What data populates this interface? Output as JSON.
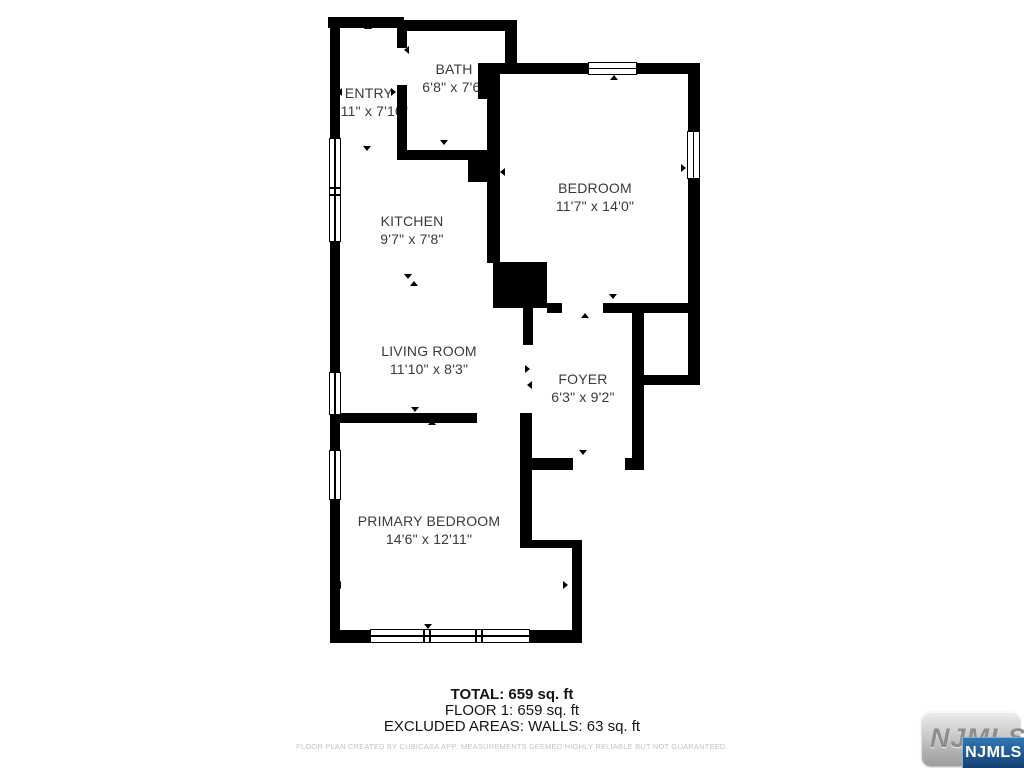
{
  "plan": {
    "rooms": [
      {
        "name": "ENTRY",
        "dimensions": "3'11\" x 7'10\""
      },
      {
        "name": "BATH",
        "dimensions": "6'8\" x 7'6\""
      },
      {
        "name": "BEDROOM",
        "dimensions": "11'7\" x 14'0\""
      },
      {
        "name": "KITCHEN",
        "dimensions": "9'7\" x 7'8\""
      },
      {
        "name": "LIVING ROOM",
        "dimensions": "11'10\" x 8'3\""
      },
      {
        "name": "FOYER",
        "dimensions": "6'3\" x 9'2\""
      },
      {
        "name": "PRIMARY BEDROOM",
        "dimensions": "14'6\" x 12'11\""
      }
    ]
  },
  "summary": {
    "total": "TOTAL: 659 sq. ft",
    "floor1": "FLOOR 1: 659 sq. ft",
    "excluded": "EXCLUDED AREAS: WALLS: 63 sq. ft",
    "disclaimer": "FLOOR PLAN CREATED BY CUBICASA APP; MEASUREMENTS DEEMED HIGHLY RELIABLE BUT NOT GUARANTEED."
  },
  "logo": {
    "back": "NJMLS",
    "front": "NJMLS"
  },
  "colors": {
    "wall": "#000000",
    "label_text": "#3a3a3a",
    "fine_print": "#c3c3c3",
    "logo_blue_top": "#3178b5",
    "logo_blue_bottom": "#143f70"
  }
}
